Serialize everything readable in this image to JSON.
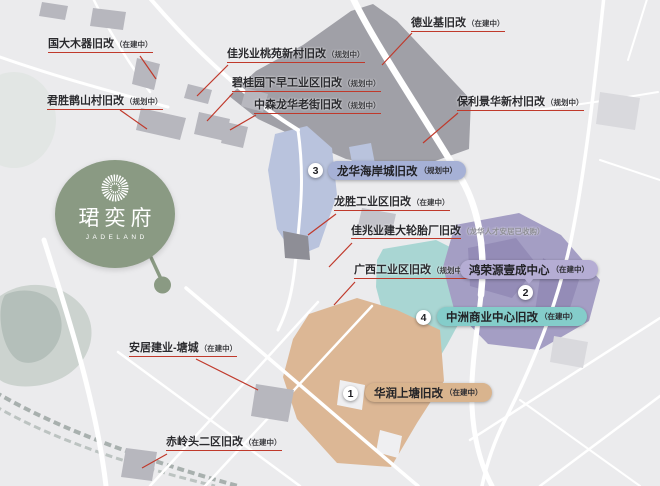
{
  "logo": {
    "name": "珺奕府",
    "subtitle": "JADELAND",
    "brand_color": "#8a9a83"
  },
  "map_labels": [
    {
      "text": "国大木器旧改",
      "status": "（在建中）"
    },
    {
      "text": "君胜鹊山村旧改",
      "status": "（规划中）"
    },
    {
      "text": "佳兆业桃苑新村旧改",
      "status": "（规划中）"
    },
    {
      "text": "碧桂园下早工业区旧改",
      "status": "（规划中）"
    },
    {
      "text": "中森龙华老街旧改",
      "status": "（规划中）"
    },
    {
      "text": "德业基旧改",
      "status": "（在建中）"
    },
    {
      "text": "保利景华新村旧改",
      "status": "（规划中）"
    },
    {
      "text": "龙胜工业区旧改",
      "status": "（在建中）"
    },
    {
      "text": "佳兆业建大轮胎厂旧改",
      "status": "（龙华人才安居已收购）"
    },
    {
      "text": "广西工业区旧改",
      "status": "（规划中）"
    },
    {
      "text": "安居建业-塘城",
      "status": "（在建中）"
    },
    {
      "text": "赤岭头二区旧改",
      "status": "（在建中）"
    }
  ],
  "numbered_projects": [
    {
      "number": "1",
      "text": "华润上塘旧改",
      "status": "（在建中）",
      "color": "#d9b48e"
    },
    {
      "number": "2",
      "text": "鸿荣源壹成中心",
      "status": "（在建中）",
      "color": "#b5add4"
    },
    {
      "number": "3",
      "text": "龙华海岸城旧改",
      "status": "（规划中）",
      "color": "#a6b1d6"
    },
    {
      "number": "4",
      "text": "中洲商业中心旧改",
      "status": "（在建中）",
      "color": "#84cdca"
    }
  ],
  "colors": {
    "background": "#ebebed",
    "leader_line": "#c0392b",
    "region_dark_gray": "#a0a0a7",
    "region_blue": "#b9c3dd",
    "region_teal": "#a9d6d3",
    "region_purple": "#a49ec4",
    "region_tan": "#dcb795"
  }
}
